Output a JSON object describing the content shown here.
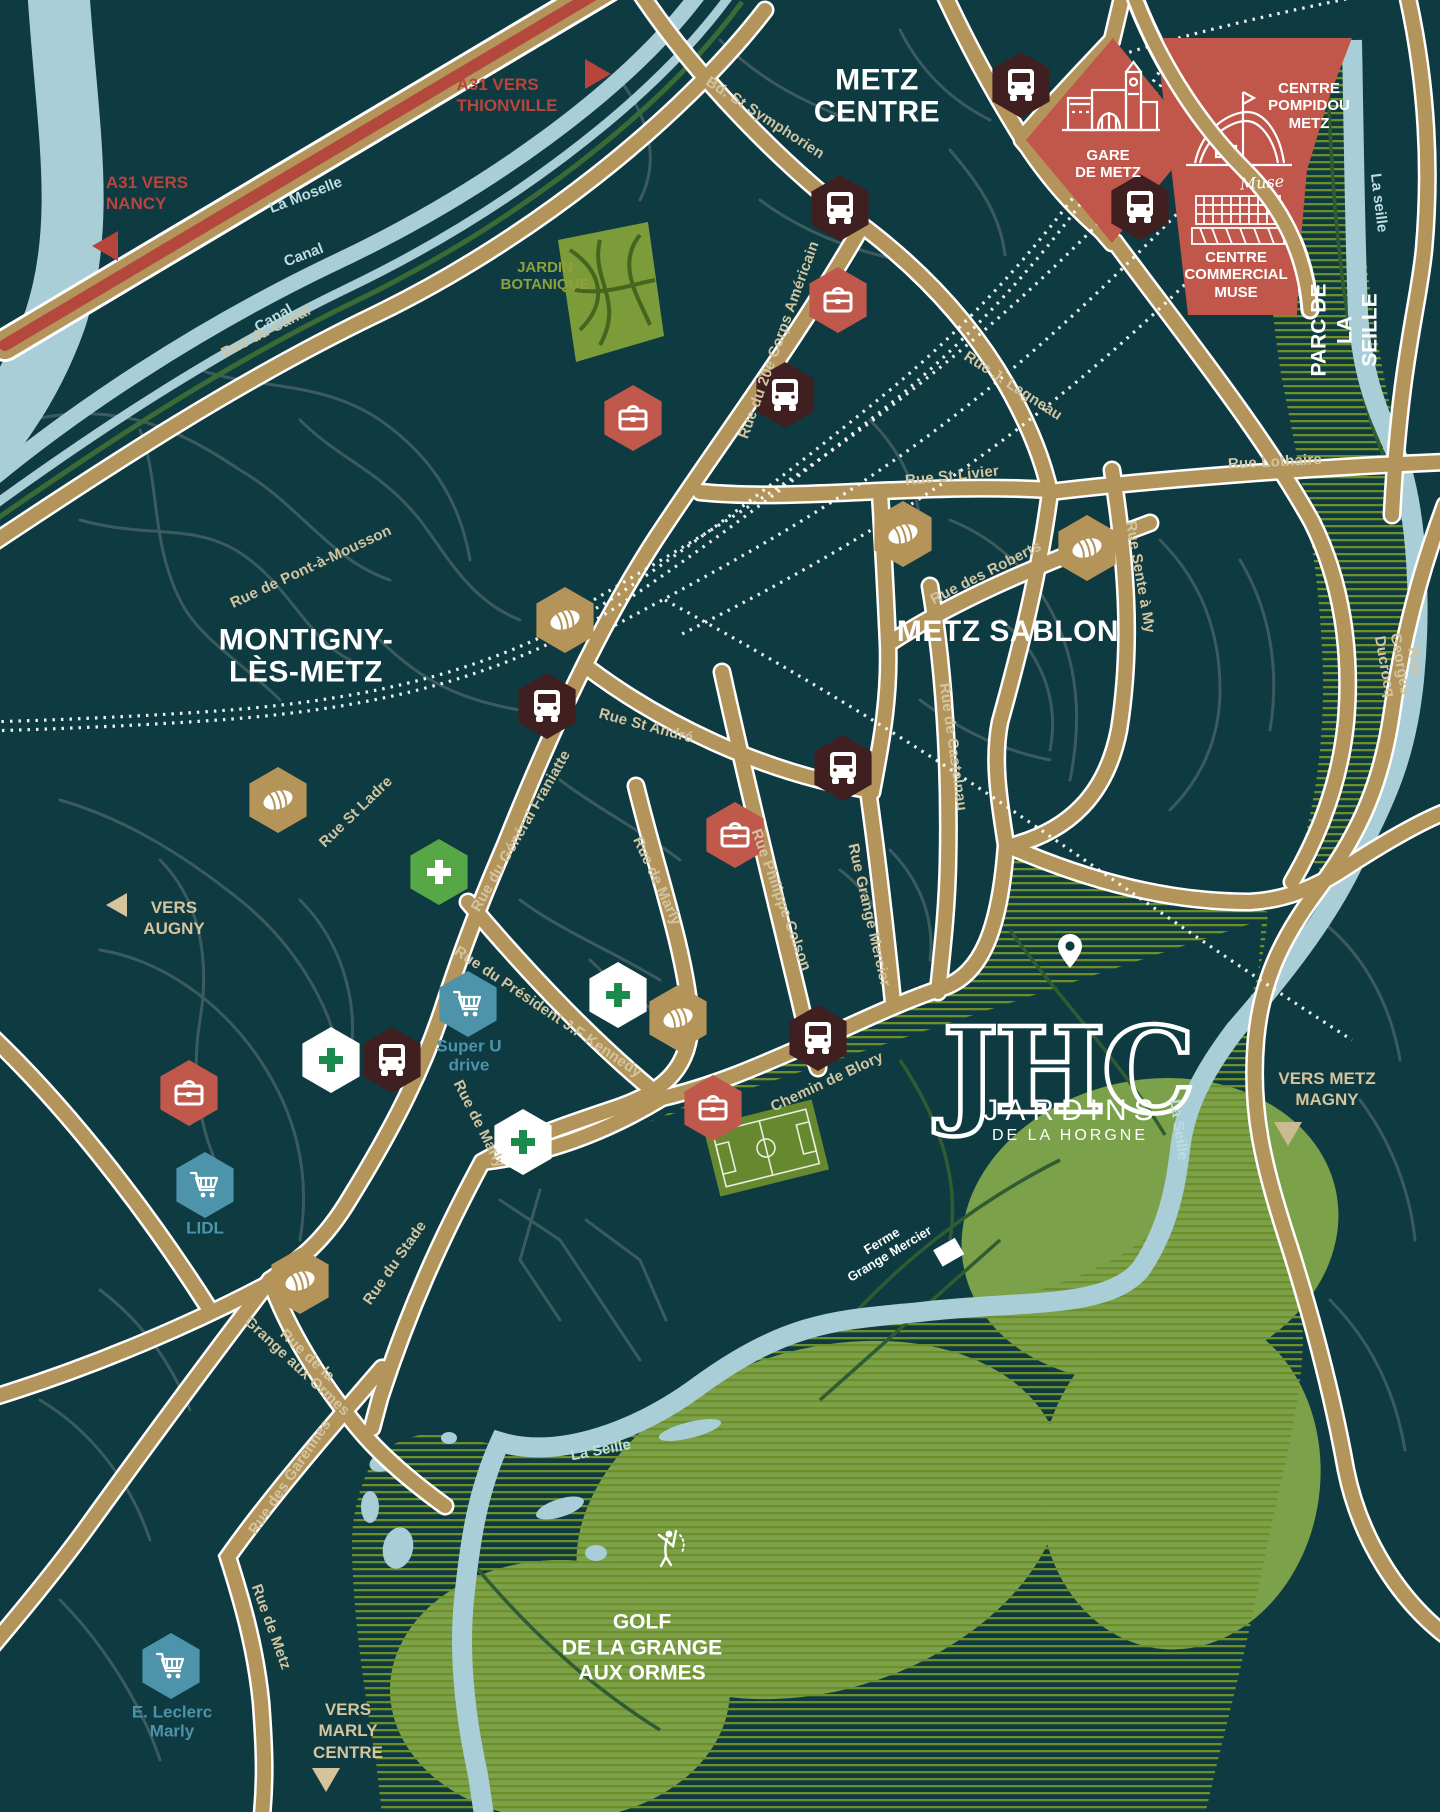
{
  "map": {
    "colors": {
      "background": "#0e3a41",
      "minor_street": "#3c5b60",
      "major_road": "#b3955c",
      "highway_red": "#b5483c",
      "water": "#a9ced8",
      "hatch_green": "#6f8e2a",
      "fairway_green": "#7ba14a",
      "park_green": "#7c9b39",
      "zone_red": "#c1564b",
      "bus_hex": "#401f20",
      "business_hex": "#c0584c",
      "bakery_hex": "#b49459",
      "pharmacy_green_hex": "#56a846",
      "pharmacy_cross_green": "#1d8a4b",
      "supermarket_hex": "#4d93a9",
      "store_text": "#4d93a9",
      "street_text": "#d2c5a2",
      "direction_red_text": "#b8453c",
      "direction_beige_text": "#d6c49c"
    },
    "labels": [
      {
        "id": "bd-st-symphorien",
        "kind": "street",
        "text": "Bd. St Symphorien",
        "x": 765,
        "y": 118,
        "rot": 33
      },
      {
        "id": "rue-20e-corps-americain",
        "kind": "street",
        "text": "Rue du 20e Corps Américain",
        "x": 779,
        "y": 340,
        "rot": -70
      },
      {
        "id": "rue-j-lagneau",
        "kind": "street",
        "text": "Rue J. Lagneau",
        "x": 1013,
        "y": 386,
        "rot": 33
      },
      {
        "id": "rue-st-livier",
        "kind": "street",
        "text": "Rue St Livier",
        "x": 952,
        "y": 476,
        "rot": -6
      },
      {
        "id": "rue-lothaire",
        "kind": "street",
        "text": "Rue Lothaire",
        "x": 1275,
        "y": 462,
        "rot": -3
      },
      {
        "id": "rue-des-roberts",
        "kind": "street",
        "text": "Rue des Roberts",
        "x": 986,
        "y": 573,
        "rot": -27
      },
      {
        "id": "rue-sente-a-my",
        "kind": "street",
        "text": "Rue Sente à My",
        "x": 1140,
        "y": 577,
        "rot": 80
      },
      {
        "id": "rue-de-castelnau",
        "kind": "street",
        "text": "Rue de Castelnau",
        "x": 953,
        "y": 747,
        "rot": 82
      },
      {
        "id": "rue-georges-ducrocq",
        "kind": "street",
        "text": "Rue Georges Ducrocq",
        "x": 1400,
        "y": 664,
        "rot": 80
      },
      {
        "id": "rue-du-canal",
        "kind": "street",
        "text": "Rue du Canal",
        "x": 266,
        "y": 332,
        "rot": -27
      },
      {
        "id": "rue-de-pont-a-mousson",
        "kind": "street",
        "text": "Rue de Pont-à-Mousson",
        "x": 311,
        "y": 567,
        "rot": -25
      },
      {
        "id": "rue-st-andre",
        "kind": "street",
        "text": "Rue St André",
        "x": 646,
        "y": 726,
        "rot": 15
      },
      {
        "id": "rue-st-ladre",
        "kind": "street",
        "text": "Rue St Ladre",
        "x": 356,
        "y": 812,
        "rot": -44
      },
      {
        "id": "rue-du-general-franiatte",
        "kind": "street",
        "text": "Rue du Général Franiatte",
        "x": 521,
        "y": 831,
        "rot": -60
      },
      {
        "id": "rue-de-marly-upper",
        "kind": "street",
        "text": "Rue de Marly",
        "x": 657,
        "y": 881,
        "rot": 65
      },
      {
        "id": "rue-philippe-colson",
        "kind": "street",
        "text": "Rue Philippe Colson",
        "x": 781,
        "y": 900,
        "rot": 70
      },
      {
        "id": "rue-grange-mercier",
        "kind": "street",
        "text": "Rue Grange Mercier",
        "x": 869,
        "y": 915,
        "rot": 77
      },
      {
        "id": "rue-president-jf-kennedy",
        "kind": "street",
        "text": "Rue du Président J.F Kennedy",
        "x": 548,
        "y": 1012,
        "rot": 34
      },
      {
        "id": "chemin-de-blory",
        "kind": "street",
        "text": "Chemin de Blory",
        "x": 827,
        "y": 1082,
        "rot": -25
      },
      {
        "id": "rue-de-marly-lower",
        "kind": "street",
        "text": "Rue de Marly",
        "x": 479,
        "y": 1124,
        "rot": 63
      },
      {
        "id": "rue-du-stade",
        "kind": "street",
        "text": "Rue du Stade",
        "x": 395,
        "y": 1263,
        "rot": -55
      },
      {
        "id": "rue-grange-aux-ormes",
        "kind": "street",
        "text": "Rue de la\nGrange aux Ormes",
        "x": 302,
        "y": 1361,
        "rot": 43
      },
      {
        "id": "rue-des-garennes",
        "kind": "street",
        "text": "Rue des Garennes",
        "x": 290,
        "y": 1477,
        "rot": -56
      },
      {
        "id": "rue-de-metz",
        "kind": "street",
        "text": "Rue de Metz",
        "x": 271,
        "y": 1627,
        "rot": 70
      },
      {
        "id": "la-moselle",
        "kind": "water",
        "text": "La Moselle",
        "x": 306,
        "y": 196,
        "rot": -21
      },
      {
        "id": "canal-1",
        "kind": "water",
        "text": "Canal",
        "x": 304,
        "y": 256,
        "rot": -21
      },
      {
        "id": "canal-2",
        "kind": "water",
        "text": "Canal",
        "x": 274,
        "y": 319,
        "rot": -30
      },
      {
        "id": "la-seille-ne",
        "kind": "water",
        "text": "La seille",
        "x": 1378,
        "y": 203,
        "rot": 83
      },
      {
        "id": "la-seille-mid",
        "kind": "water",
        "text": "La Seille",
        "x": 1178,
        "y": 1130,
        "rot": 82
      },
      {
        "id": "la-seille-s",
        "kind": "water",
        "text": "La Seille",
        "x": 601,
        "y": 1451,
        "rot": -11
      },
      {
        "id": "metz-centre",
        "kind": "area",
        "text": "METZ\nCENTRE",
        "x": 877,
        "y": 97,
        "rot": 0
      },
      {
        "id": "montigny-les-metz",
        "kind": "area",
        "text": "MONTIGNY-\nLÈS-METZ",
        "x": 306,
        "y": 657,
        "rot": 0
      },
      {
        "id": "metz-sablon",
        "kind": "area",
        "text": "METZ SABLON",
        "x": 1008,
        "y": 632,
        "rot": 0
      },
      {
        "id": "golf-grange-aux-ormes",
        "kind": "area-md",
        "text": "GOLF\nDE LA GRANGE\nAUX ORMES",
        "x": 642,
        "y": 1648,
        "rot": 0
      },
      {
        "id": "jardin-botanique",
        "kind": "olive",
        "text": "JARDIN\nBOTANIQUE",
        "x": 545,
        "y": 276,
        "rot": 0
      },
      {
        "id": "parc-de-la-seille",
        "kind": "area-md",
        "text": "PARC DE LA SEILLE",
        "x": 1345,
        "y": 330,
        "rot": -90
      },
      {
        "id": "a31-vers-thionville",
        "kind": "dir-red",
        "text": "A31 VERS\nTHIONVILLE",
        "x": 507,
        "y": 95,
        "rot": 0
      },
      {
        "id": "a31-vers-nancy",
        "kind": "dir-red",
        "text": "A31 VERS\nNANCY",
        "x": 147,
        "y": 193,
        "rot": 0
      },
      {
        "id": "vers-augny",
        "kind": "dir",
        "text": "VERS\nAUGNY",
        "x": 174,
        "y": 918,
        "rot": 0
      },
      {
        "id": "vers-metz-magny",
        "kind": "dir",
        "text": "VERS METZ\nMAGNY",
        "x": 1327,
        "y": 1089,
        "rot": 0
      },
      {
        "id": "vers-marly-centre",
        "kind": "dir",
        "text": "VERS\nMARLY\nCENTRE",
        "x": 348,
        "y": 1731,
        "rot": 0
      },
      {
        "id": "super-u-drive",
        "kind": "store",
        "text": "Super U\ndrive",
        "x": 469,
        "y": 1056,
        "rot": 0
      },
      {
        "id": "lidl",
        "kind": "store",
        "text": "LIDL",
        "x": 205,
        "y": 1229,
        "rot": 0
      },
      {
        "id": "e-leclerc-marly",
        "kind": "store",
        "text": "E. Leclerc\nMarly",
        "x": 172,
        "y": 1722,
        "rot": 0
      },
      {
        "id": "ferme-grange-mercier",
        "kind": "place-white",
        "text": "Ferme\nGrange Mercier",
        "x": 886,
        "y": 1248,
        "rot": -31
      }
    ],
    "landmarks": {
      "gare": {
        "title": "GARE\nDE METZ"
      },
      "pompidou": {
        "title": "CENTRE\nPOMPIDOU\nMETZ"
      },
      "muse": {
        "script": "Muse",
        "title": "CENTRE\nCOMMERCIAL\nMUSE"
      }
    },
    "logo": {
      "monogram": "JHC",
      "title": "JARDINS",
      "subtitle": "DE LA HORGNE"
    },
    "pois": [
      {
        "id": "bus-stop-1",
        "type": "bus-stop",
        "x": 1021,
        "y": 85
      },
      {
        "id": "bus-stop-2",
        "type": "bus-stop",
        "x": 840,
        "y": 208
      },
      {
        "id": "bus-stop-3",
        "type": "bus-stop",
        "x": 1140,
        "y": 207
      },
      {
        "id": "bus-stop-4",
        "type": "bus-stop",
        "x": 785,
        "y": 395
      },
      {
        "id": "bus-stop-5",
        "type": "bus-stop",
        "x": 547,
        "y": 706
      },
      {
        "id": "bus-stop-6",
        "type": "bus-stop",
        "x": 843,
        "y": 768
      },
      {
        "id": "bus-stop-7",
        "type": "bus-stop",
        "x": 392,
        "y": 1060
      },
      {
        "id": "bus-stop-8",
        "type": "bus-stop",
        "x": 818,
        "y": 1038
      },
      {
        "id": "business-1",
        "type": "business",
        "x": 838,
        "y": 300
      },
      {
        "id": "business-2",
        "type": "business",
        "x": 633,
        "y": 418
      },
      {
        "id": "business-3",
        "type": "business",
        "x": 735,
        "y": 835
      },
      {
        "id": "business-4",
        "type": "business",
        "x": 189,
        "y": 1093
      },
      {
        "id": "business-5",
        "type": "business",
        "x": 713,
        "y": 1108
      },
      {
        "id": "bakery-1",
        "type": "bakery",
        "x": 903,
        "y": 534
      },
      {
        "id": "bakery-2",
        "type": "bakery",
        "x": 1087,
        "y": 548
      },
      {
        "id": "bakery-3",
        "type": "bakery",
        "x": 565,
        "y": 620
      },
      {
        "id": "bakery-4",
        "type": "bakery",
        "x": 278,
        "y": 800
      },
      {
        "id": "bakery-5",
        "type": "bakery",
        "x": 678,
        "y": 1018
      },
      {
        "id": "bakery-6",
        "type": "bakery",
        "x": 300,
        "y": 1281
      },
      {
        "id": "pharmacy-1",
        "type": "pharmacy-green",
        "x": 439,
        "y": 872
      },
      {
        "id": "pharmacy-2",
        "type": "pharmacy-white",
        "x": 618,
        "y": 995
      },
      {
        "id": "pharmacy-3",
        "type": "pharmacy-white",
        "x": 331,
        "y": 1060
      },
      {
        "id": "pharmacy-4",
        "type": "pharmacy-white",
        "x": 523,
        "y": 1142
      },
      {
        "id": "supermarket-super-u",
        "type": "supermarket",
        "x": 468,
        "y": 1004
      },
      {
        "id": "supermarket-lidl",
        "type": "supermarket",
        "x": 205,
        "y": 1185
      },
      {
        "id": "supermarket-leclerc",
        "type": "supermarket",
        "x": 171,
        "y": 1666
      }
    ]
  }
}
